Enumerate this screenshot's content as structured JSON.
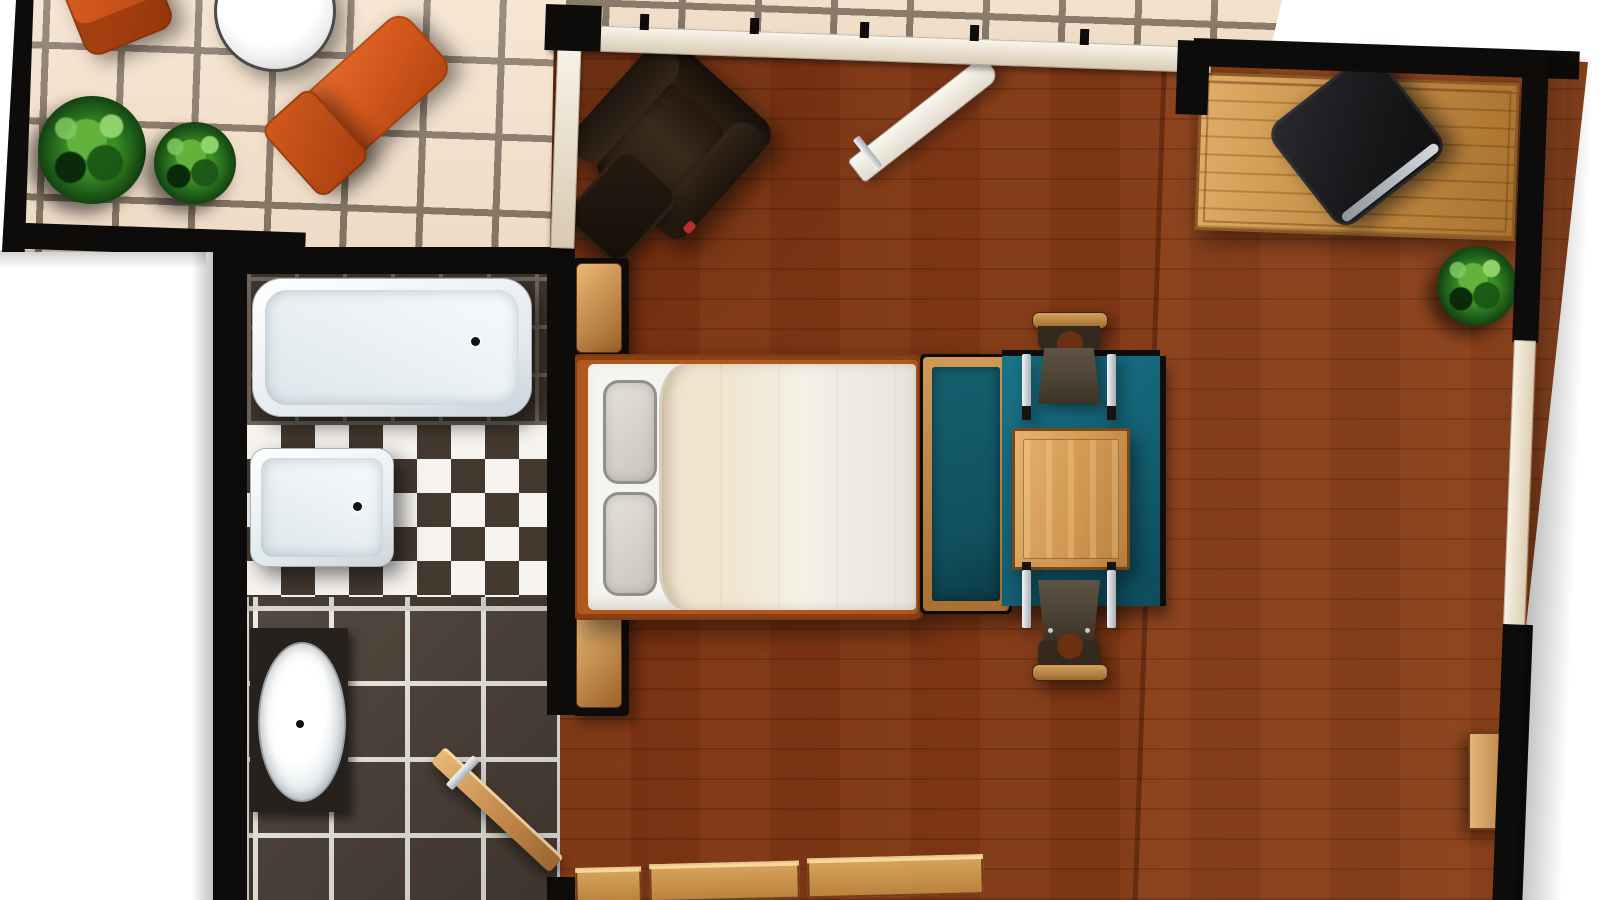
{
  "scene": {
    "type": "floor-plan",
    "title": "Studio apartment floor plan (top-down 3D render)",
    "rooms": [
      {
        "id": "terrace",
        "label": "Terrace",
        "furniture": [
          "sun lounger",
          "sun lounger",
          "round table",
          "shrub",
          "shrub"
        ]
      },
      {
        "id": "bathroom",
        "label": "Bathroom",
        "furniture": [
          "bathtub",
          "shower tray",
          "washbasin on counter",
          "wooden door (open)"
        ]
      },
      {
        "id": "main-room",
        "label": "Bedroom / Living room",
        "furniture": [
          "armchair",
          "ottoman",
          "entry door (open)",
          "nightstand",
          "nightstand",
          "double bed with two pillows and duvet",
          "bench with teal cushion",
          "teal rug",
          "dining table",
          "dining chair",
          "dining chair",
          "desk",
          "black desk chair",
          "potted plant",
          "wall shelf",
          "sideboard (cut off at bottom edge)"
        ]
      }
    ]
  },
  "palette": {
    "wall_black": "#0d0c0a",
    "wall_beige": "#d8c9b2",
    "terrace_tile": "#f2e2cd",
    "terrace_grout": "#54493c",
    "wood_base": "#7a3414",
    "bath_tile": "#4a3f35",
    "bath_grout": "#efece6",
    "small_tile": "#3e352c",
    "small_grout": "#6e645a",
    "checker_dark": "#44392f",
    "checker_white": "#f7f4f0",
    "rug_teal": "#136073",
    "bench_teal": "#11505e",
    "lounger_orange": "#d95b21",
    "fixture_white": "#f4f8fa",
    "wood_furniture": "#c8904e",
    "chair_seat": "#4e4436",
    "metal": "#b9bfc5",
    "plant_green": "#3c8f28",
    "accent_red": "#bd2b2e",
    "duvet": "#f0e6d2",
    "mattress": "#f6f4ef",
    "armchair_brown": "#2e2114"
  }
}
